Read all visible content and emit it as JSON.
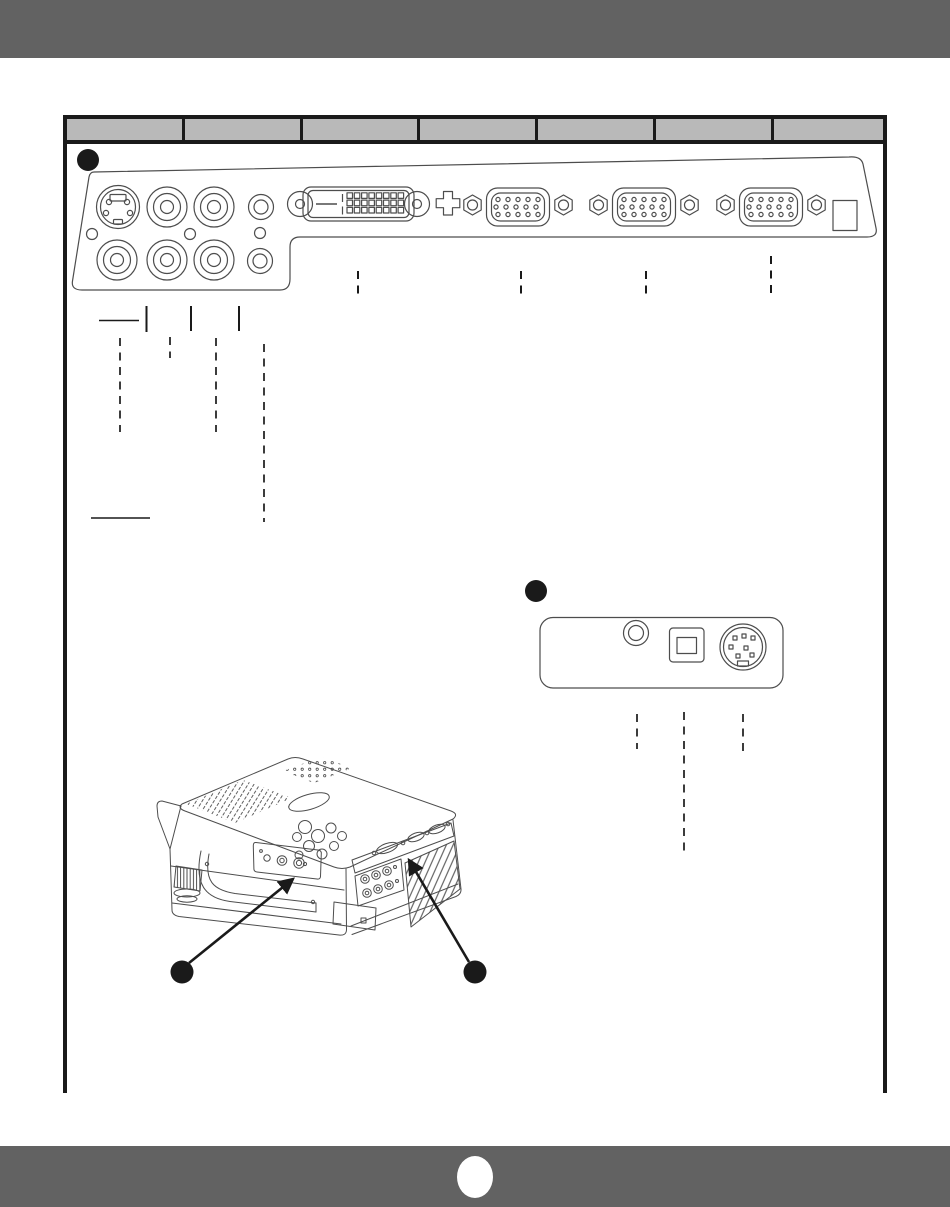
{
  "page": {
    "width": 950,
    "height": 1207,
    "background": "#ffffff"
  },
  "header_bar": {
    "color": "#626262"
  },
  "footer_bar": {
    "color": "#626262",
    "page_circle_text": ""
  },
  "table": {
    "border_color": "#1a1a1a",
    "header_fill": "#b9b9b9",
    "columns": [
      "",
      "",
      "",
      "",
      "",
      "",
      ""
    ]
  },
  "figure_a": {
    "badge_label": "",
    "panel_name": "rear-terminal-panel",
    "connectors": [
      "s-video-jack",
      "rca-jack",
      "rca-jack",
      "audio-minijack",
      "rca-jack",
      "rca-jack",
      "rca-jack",
      "audio-minijack",
      "screw-hole",
      "screw-hole",
      "screw-hole",
      "dvi-port",
      "thumbscrew",
      "d-sub-15-port",
      "d-sub-15-port",
      "d-sub-15-port",
      "ac-inlet-square"
    ]
  },
  "figure_b": {
    "badge_label": "",
    "panel_name": "control-terminal-panel",
    "connectors": [
      "audio-minijack",
      "usb-type-b-port",
      "mini-din-8-port"
    ]
  },
  "projector_figure": {
    "callouts": [
      {
        "label": "",
        "target": "side-terminal-panel"
      },
      {
        "label": "",
        "target": "rear-terminal-panel"
      }
    ]
  },
  "line_art_color": "#4d4d4d",
  "accent_black": "#1a1a1a"
}
